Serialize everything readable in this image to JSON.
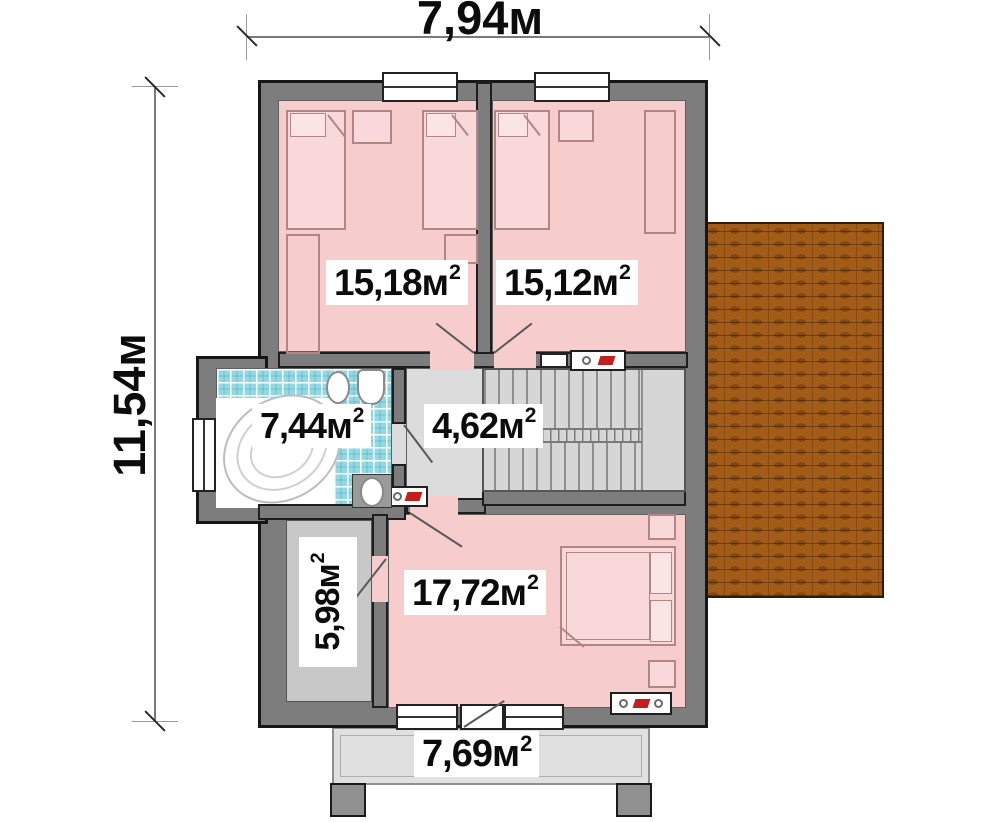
{
  "dimensions": {
    "width_label": "7,94м",
    "height_label": "11,54м"
  },
  "rooms": {
    "bedroom_top_left": {
      "value": "15,18",
      "unit": "м",
      "sup": "2"
    },
    "bedroom_top_right": {
      "value": "15,12",
      "unit": "м",
      "sup": "2"
    },
    "bathroom": {
      "value": "7,44",
      "unit": "м",
      "sup": "2"
    },
    "hall": {
      "value": "4,62",
      "unit": "м",
      "sup": "2"
    },
    "wardrobe": {
      "value": "5,98",
      "unit": "м",
      "sup": "2"
    },
    "bedroom_master": {
      "value": "17,72",
      "unit": "м",
      "sup": "2"
    },
    "terrace": {
      "value": "7,69",
      "unit": "м",
      "sup": "2"
    }
  },
  "colors": {
    "wall": "#7d7d7d",
    "room_pink": "#f6cccc",
    "tile_blue": "#93d9e3",
    "hall_gray": "#dcdcdc",
    "wardrobe_gray": "#c8c8c8",
    "terrace_gray": "#e0e0e0",
    "roof_orange": "#a35c17",
    "accent_red": "#c41f1f"
  }
}
